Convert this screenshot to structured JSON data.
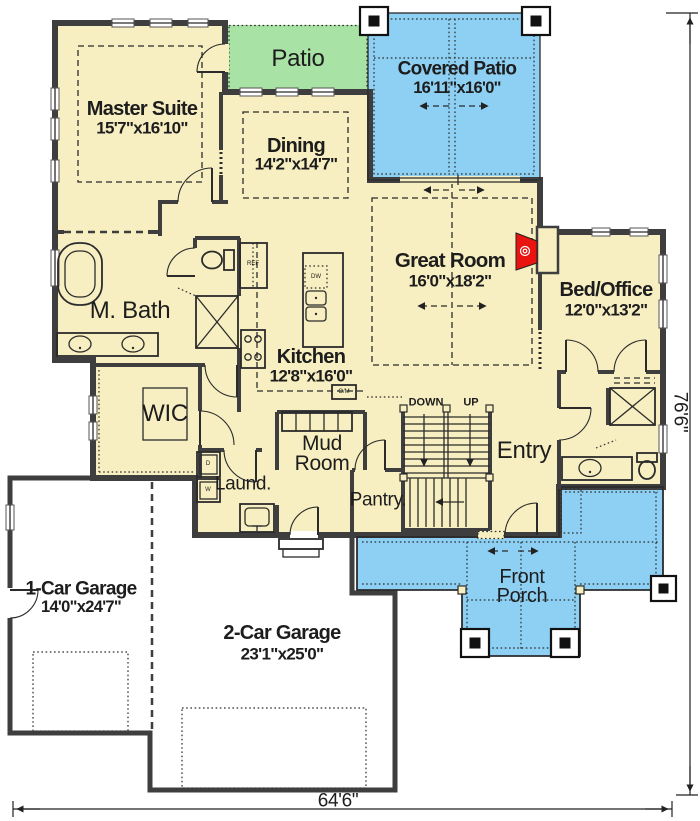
{
  "colors": {
    "room_fill": "#f7efc1",
    "patio_green": "#a9e2a5",
    "porch_blue": "#8dd0f3",
    "garage_fill": "#ffffff",
    "wall": "#3e3e3e",
    "line": "#2b2b2b",
    "accent_red": "#e9130f",
    "text": "#1d1d1d"
  },
  "rooms": {
    "master_suite": {
      "label": "Master Suite",
      "dims": "15'7\"x16'10\""
    },
    "dining": {
      "label": "Dining",
      "dims": "14'2\"x14'7\""
    },
    "patio": {
      "label": "Patio"
    },
    "covered_patio": {
      "label": "Covered Patio",
      "dims": "16'11\"x16'0\""
    },
    "great_room": {
      "label": "Great Room",
      "dims": "16'0\"x18'2\""
    },
    "bed_office": {
      "label": "Bed/Office",
      "dims": "12'0\"x13'2\""
    },
    "kitchen": {
      "label": "Kitchen",
      "dims": "12'8\"x16'0\""
    },
    "m_bath": {
      "label": "M. Bath"
    },
    "wic": {
      "label": "WIC"
    },
    "mud_room": {
      "label": "Mud Room"
    },
    "laundry": {
      "label": "Laund."
    },
    "pantry": {
      "label": "Pantry."
    },
    "entry": {
      "label": "Entry"
    },
    "front_porch": {
      "label": "Front Porch"
    },
    "garage_1": {
      "label": "1-Car Garage",
      "dims": "14'0\"x24'7\""
    },
    "garage_2": {
      "label": "2-Car Garage",
      "dims": "23'1\"x25'0\""
    }
  },
  "stairs": {
    "down": "DOWN",
    "up": "UP"
  },
  "appliances": {
    "ref": "REF",
    "dw": "DW",
    "oven_micro": "O/M",
    "dryer": "D",
    "washer": "W"
  },
  "dimensions": {
    "width": "64'6\"",
    "height": "76'6\""
  }
}
